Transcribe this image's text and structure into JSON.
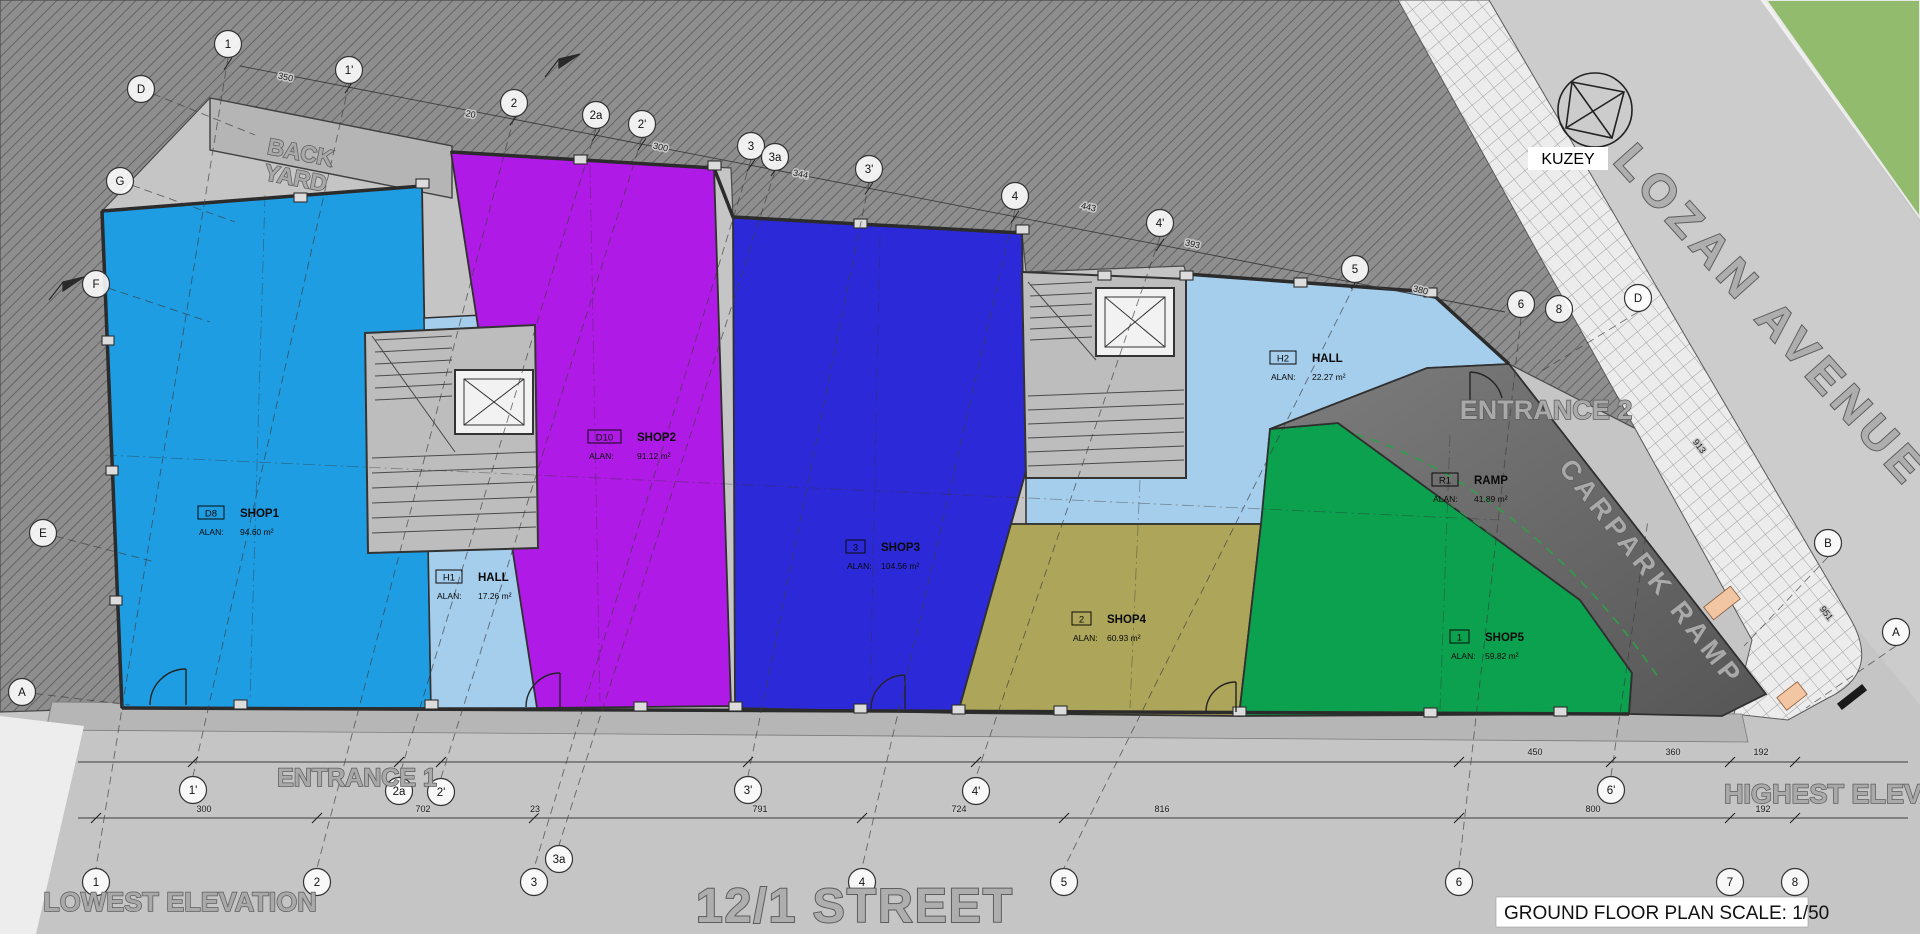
{
  "title": {
    "label": "GROUND FLOOR PLAN SCALE: 1/50"
  },
  "compass": {
    "label": "KUZEY"
  },
  "texts": {
    "street_bottom": "12/1 STREET",
    "avenue": "LOZAN AVENUE",
    "carpark_ramp": "CARPARK RAMP",
    "back_yard_line1": "BACK",
    "back_yard_line2": "YARD",
    "entrance1": "ENTRANCE 1",
    "entrance2": "ENTRANCE 2",
    "lowest_elevation": "LOWEST ELEVATION",
    "highest_elevation": "HIGHEST ELEVATION"
  },
  "rooms": [
    {
      "id": "shop1",
      "code": "D8",
      "name": "SHOP1",
      "area_label": "ALAN:",
      "area": "94.60 m²",
      "x": 198,
      "y": 506
    },
    {
      "id": "shop2",
      "code": "D10",
      "name": "SHOP2",
      "area_label": "ALAN:",
      "area": "91.12 m²",
      "x": 588,
      "y": 430
    },
    {
      "id": "shop3",
      "code": "3",
      "name": "SHOP3",
      "area_label": "ALAN:",
      "area": "104.56 m²",
      "x": 846,
      "y": 540
    },
    {
      "id": "shop4",
      "code": "2",
      "name": "SHOP4",
      "area_label": "ALAN:",
      "area": "60.93 m²",
      "x": 1072,
      "y": 612
    },
    {
      "id": "shop5",
      "code": "1",
      "name": "SHOP5",
      "area_label": "ALAN:",
      "area": "59.82 m²",
      "x": 1450,
      "y": 630
    },
    {
      "id": "hall1",
      "code": "H1",
      "name": "HALL",
      "area_label": "ALAN:",
      "area": "17.26 m²",
      "x": 436,
      "y": 570
    },
    {
      "id": "hall2",
      "code": "H2",
      "name": "HALL",
      "area_label": "ALAN:",
      "area": "22.27 m²",
      "x": 1270,
      "y": 351
    },
    {
      "id": "ramp",
      "code": "R1",
      "name": "RAMP",
      "area_label": "ALAN:",
      "area": "41.89 m²",
      "x": 1432,
      "y": 473
    }
  ],
  "grid": {
    "bubbles": [
      {
        "label": "1",
        "x": 228,
        "y": 44
      },
      {
        "label": "1'",
        "x": 349,
        "y": 70
      },
      {
        "label": "2",
        "x": 514,
        "y": 103
      },
      {
        "label": "2a",
        "x": 596,
        "y": 115
      },
      {
        "label": "2'",
        "x": 642,
        "y": 124
      },
      {
        "label": "3",
        "x": 751,
        "y": 146
      },
      {
        "label": "3a",
        "x": 775,
        "y": 157
      },
      {
        "label": "3'",
        "x": 869,
        "y": 169
      },
      {
        "label": "4",
        "x": 1015,
        "y": 196
      },
      {
        "label": "4'",
        "x": 1160,
        "y": 223
      },
      {
        "label": "5",
        "x": 1355,
        "y": 269
      },
      {
        "label": "6",
        "x": 1521,
        "y": 304
      },
      {
        "label": "8",
        "x": 1559,
        "y": 309
      },
      {
        "label": "D",
        "x": 1638,
        "y": 298
      },
      {
        "label": "B",
        "x": 1828,
        "y": 543
      },
      {
        "label": "A",
        "x": 1896,
        "y": 632
      },
      {
        "label": "D",
        "x": 141,
        "y": 89
      },
      {
        "label": "G",
        "x": 120,
        "y": 181
      },
      {
        "label": "F",
        "x": 96,
        "y": 284
      },
      {
        "label": "E",
        "x": 43,
        "y": 533
      },
      {
        "label": "A",
        "x": 22,
        "y": 692
      },
      {
        "label": "1'",
        "x": 193,
        "y": 790
      },
      {
        "label": "2a",
        "x": 399,
        "y": 791
      },
      {
        "label": "2'",
        "x": 441,
        "y": 792
      },
      {
        "label": "3'",
        "x": 748,
        "y": 790
      },
      {
        "label": "4'",
        "x": 976,
        "y": 791
      },
      {
        "label": "6'",
        "x": 1611,
        "y": 790
      },
      {
        "label": "1",
        "x": 96,
        "y": 882
      },
      {
        "label": "2",
        "x": 317,
        "y": 882
      },
      {
        "label": "3",
        "x": 534,
        "y": 882
      },
      {
        "label": "3a",
        "x": 559,
        "y": 859
      },
      {
        "label": "4",
        "x": 862,
        "y": 882
      },
      {
        "label": "5",
        "x": 1064,
        "y": 882
      },
      {
        "label": "6",
        "x": 1459,
        "y": 882
      },
      {
        "label": "7",
        "x": 1730,
        "y": 882
      },
      {
        "label": "8",
        "x": 1795,
        "y": 882
      }
    ]
  },
  "dimensions": {
    "chain_upper": [
      {
        "text": "450",
        "x": 1535,
        "y": 755,
        "rot": 0
      },
      {
        "text": "360",
        "x": 1673,
        "y": 755,
        "rot": 0
      },
      {
        "text": "192",
        "x": 1761,
        "y": 755,
        "rot": 0
      }
    ],
    "chain_lower": [
      {
        "text": "300",
        "x": 204,
        "y": 812,
        "rot": 0
      },
      {
        "text": "702",
        "x": 423,
        "y": 812,
        "rot": 0
      },
      {
        "text": "23",
        "x": 535,
        "y": 812,
        "rot": 0
      },
      {
        "text": "791",
        "x": 760,
        "y": 812,
        "rot": 0
      },
      {
        "text": "724",
        "x": 959,
        "y": 812,
        "rot": 0
      },
      {
        "text": "816",
        "x": 1162,
        "y": 812,
        "rot": 0
      },
      {
        "text": "800",
        "x": 1593,
        "y": 812,
        "rot": 0
      },
      {
        "text": "192",
        "x": 1763,
        "y": 812,
        "rot": 0
      }
    ],
    "chain_top": [
      {
        "text": "350",
        "x": 285,
        "y": 80,
        "rot": 12
      },
      {
        "text": "20",
        "x": 470,
        "y": 117,
        "rot": 12
      },
      {
        "text": "300",
        "x": 660,
        "y": 150,
        "rot": 12
      },
      {
        "text": "344",
        "x": 800,
        "y": 177,
        "rot": 12
      },
      {
        "text": "443",
        "x": 1088,
        "y": 210,
        "rot": 13
      },
      {
        "text": "393",
        "x": 1192,
        "y": 247,
        "rot": 13
      },
      {
        "text": "380",
        "x": 1420,
        "y": 293,
        "rot": 13
      }
    ],
    "chain_diag": [
      {
        "text": "913",
        "x": 1697,
        "y": 448,
        "rot": 53
      },
      {
        "text": "951",
        "x": 1824,
        "y": 615,
        "rot": 53
      }
    ]
  },
  "colors": {
    "shop1": "#1e9de2",
    "shop2": "#b01ae6",
    "shop3": "#2c29d8",
    "shop4": "#aca55a",
    "shop5": "#0ba14e",
    "hall": "#a5cdec",
    "ramp_fill": "#6f6f6f",
    "ramp_dash": "#2f9e49",
    "green_corner": "#92bb6d",
    "peach": "#f2c6a2"
  }
}
